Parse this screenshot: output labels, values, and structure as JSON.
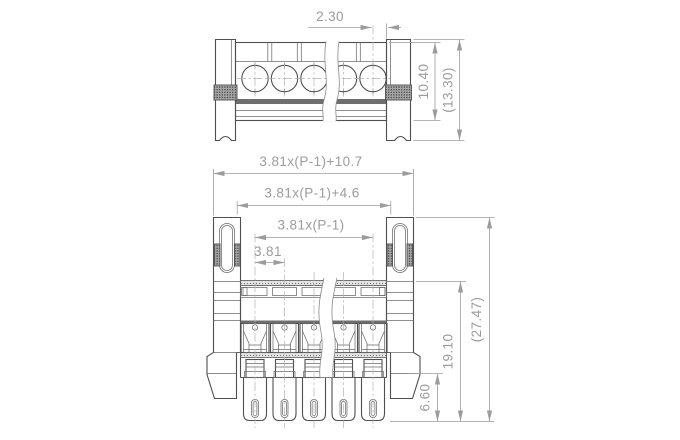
{
  "drawing": {
    "top_view": {
      "dim_screw_to_flange": "2.30",
      "dim_body_height": "10.40",
      "dim_overall_height": "(13.30)"
    },
    "front_view": {
      "dim_overall_width": "3.81x(P-1)+10.7",
      "dim_flange_inner_width": "3.81x(P-1)+4.6",
      "dim_pole_span": "3.81x(P-1)",
      "dim_pitch": "3.81",
      "dim_pin_length": "6.60",
      "dim_housing_height": "19.10",
      "dim_overall_height": "(27.47)"
    }
  }
}
